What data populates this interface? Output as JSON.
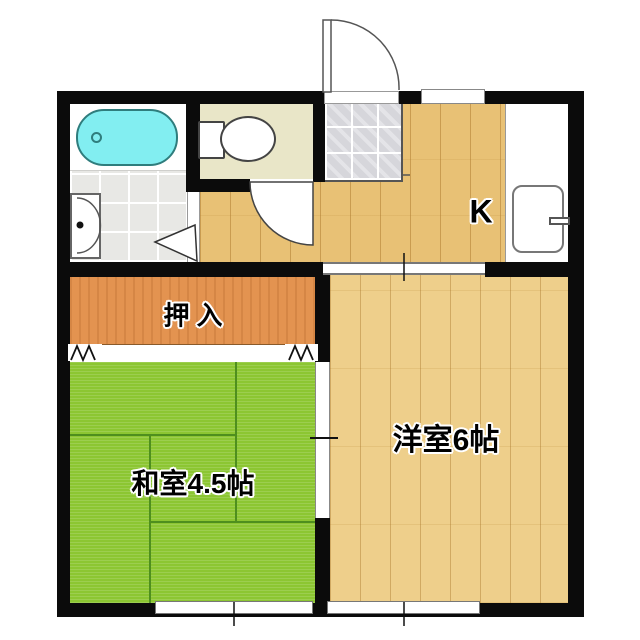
{
  "plan": {
    "kitchen_label": "K",
    "western_room_label": "洋室6帖",
    "japanese_room_label": "和室4.5帖",
    "closet_label": "押入"
  },
  "colors": {
    "wall": "#0b0b0b",
    "tatami": "#8cc632",
    "tatami_line": "#4e8f1e",
    "wood_kitchen": "#e8c175",
    "wood_western": "#eecf8b",
    "closet": "#e39350",
    "bathtub": "#82eef1",
    "toilet_floor": "#e9e6c8",
    "entrance_tile": "#d6d6db",
    "washroom_tile": "#e8e8e5"
  },
  "fixtures": [
    "bathtub",
    "bath-drain",
    "washbasin",
    "toilet",
    "kitchen-sink",
    "faucet",
    "entrance-door",
    "toilet-door",
    "washroom-door",
    "sliding-door",
    "closet-fusuma",
    "window-south-left",
    "window-south-right",
    "window-kitchen"
  ]
}
